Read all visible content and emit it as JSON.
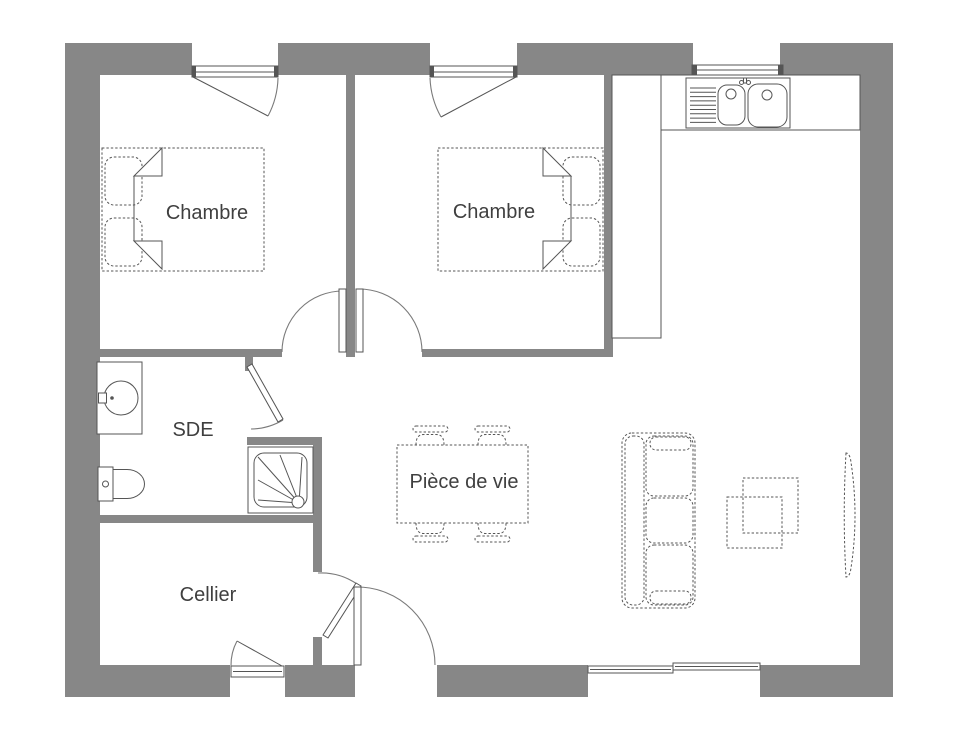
{
  "colors": {
    "wall": "#878787",
    "line": "#555555",
    "arc": "#7a7a7a",
    "text": "#3f3f3f",
    "background": "#ffffff"
  },
  "rooms": [
    {
      "id": "chambre-1",
      "label": "Chambre"
    },
    {
      "id": "chambre-2",
      "label": "Chambre"
    },
    {
      "id": "sde",
      "label": "SDE"
    },
    {
      "id": "cellier",
      "label": "Cellier"
    },
    {
      "id": "piece-de-vie",
      "label": "Pièce de vie"
    }
  ],
  "symbols": [
    {
      "name": "double-bed-with-pillows",
      "room": "chambre-1"
    },
    {
      "name": "double-bed-with-pillows",
      "room": "chambre-2"
    },
    {
      "name": "kitchen-tall-cabinet",
      "room": "piece-de-vie"
    },
    {
      "name": "kitchen-counter-double-sink",
      "room": "piece-de-vie"
    },
    {
      "name": "washbasin",
      "room": "sde"
    },
    {
      "name": "toilet",
      "room": "sde"
    },
    {
      "name": "shower-tray",
      "room": "sde"
    },
    {
      "name": "dining-table-4-chairs",
      "room": "piece-de-vie"
    },
    {
      "name": "three-seat-sofa",
      "room": "piece-de-vie"
    },
    {
      "name": "nested-coffee-tables",
      "room": "piece-de-vie"
    },
    {
      "name": "tv-unit",
      "room": "piece-de-vie"
    }
  ],
  "openings": {
    "windows": 5,
    "interior_doors": 4,
    "entrance_doors": 1
  }
}
